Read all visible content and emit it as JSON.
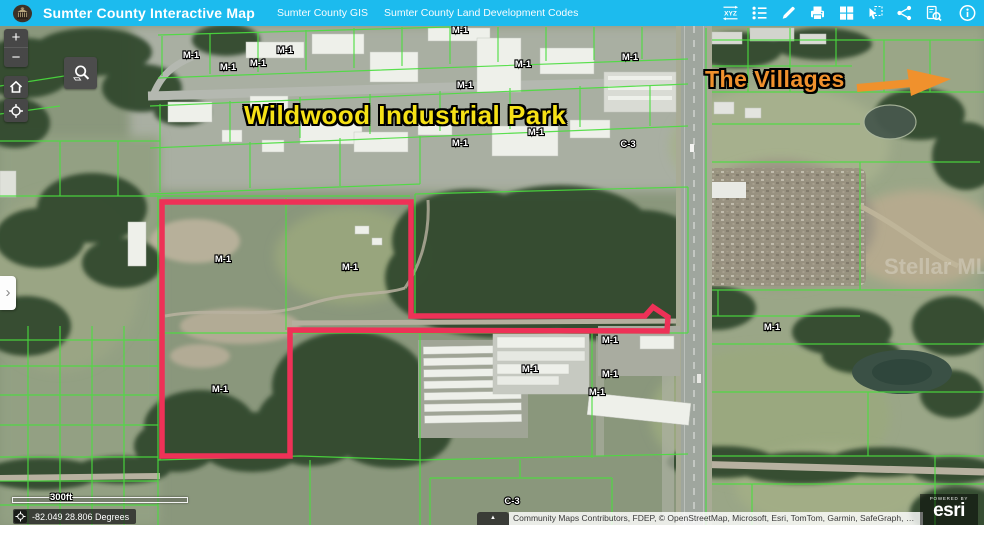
{
  "header": {
    "app_title": "Sumter County Interactive Map",
    "links": [
      {
        "label": "Sumter County GIS"
      },
      {
        "label": "Sumter County Land Development Codes"
      }
    ],
    "tools": [
      {
        "name": "xyz-coordinates",
        "glyph": "XYZ"
      },
      {
        "name": "legend"
      },
      {
        "name": "draw-measure"
      },
      {
        "name": "print"
      },
      {
        "name": "basemap-gallery"
      },
      {
        "name": "select-features"
      },
      {
        "name": "share"
      },
      {
        "name": "query-attributes"
      },
      {
        "name": "about-info"
      }
    ],
    "bar_color": "#1CBBEE"
  },
  "map": {
    "big_labels": {
      "industrial_park": "Wildwood Industrial Park",
      "villages": "The Villages"
    },
    "zone_labels": [
      {
        "text": "M-1",
        "x": 191,
        "y": 32
      },
      {
        "text": "M-1",
        "x": 228,
        "y": 44
      },
      {
        "text": "M-1",
        "x": 258,
        "y": 40
      },
      {
        "text": "M-1",
        "x": 285,
        "y": 27
      },
      {
        "text": "M-1",
        "x": 460,
        "y": 7
      },
      {
        "text": "M-1",
        "x": 523,
        "y": 41
      },
      {
        "text": "M-1",
        "x": 630,
        "y": 34
      },
      {
        "text": "M-1",
        "x": 465,
        "y": 62
      },
      {
        "text": "M-1",
        "x": 536,
        "y": 109
      },
      {
        "text": "M-1",
        "x": 460,
        "y": 120
      },
      {
        "text": "C-3",
        "x": 628,
        "y": 121
      },
      {
        "text": "M-1",
        "x": 223,
        "y": 236
      },
      {
        "text": "M-1",
        "x": 350,
        "y": 244
      },
      {
        "text": "M-1",
        "x": 220,
        "y": 366
      },
      {
        "text": "M-1",
        "x": 530,
        "y": 346
      },
      {
        "text": "M-1",
        "x": 610,
        "y": 317
      },
      {
        "text": "M-1",
        "x": 610,
        "y": 351
      },
      {
        "text": "M-1",
        "x": 597,
        "y": 369
      },
      {
        "text": "M-1",
        "x": 772,
        "y": 304
      },
      {
        "text": "C-3",
        "x": 512,
        "y": 478
      }
    ],
    "watermark": "Stellar MLS",
    "colors": {
      "parcel_line": "#4ADE3E",
      "selection_outline": "#EE3157",
      "industrial_label": "#F6E116",
      "villages_label": "#F0912D"
    },
    "controls": {
      "zoom_in": "+",
      "zoom_out": "−"
    }
  },
  "statusbar": {
    "scale_label": "300ft",
    "coordinates": "-82.049 28.806 Degrees",
    "attribution": "Community Maps Contributors, FDEP, © OpenStreetMap, Microsoft, Esri, TomTom, Garmin, SafeGraph, …",
    "attribution_toggle": "▲",
    "powered_by": "POWERED BY",
    "brand": "esri"
  }
}
